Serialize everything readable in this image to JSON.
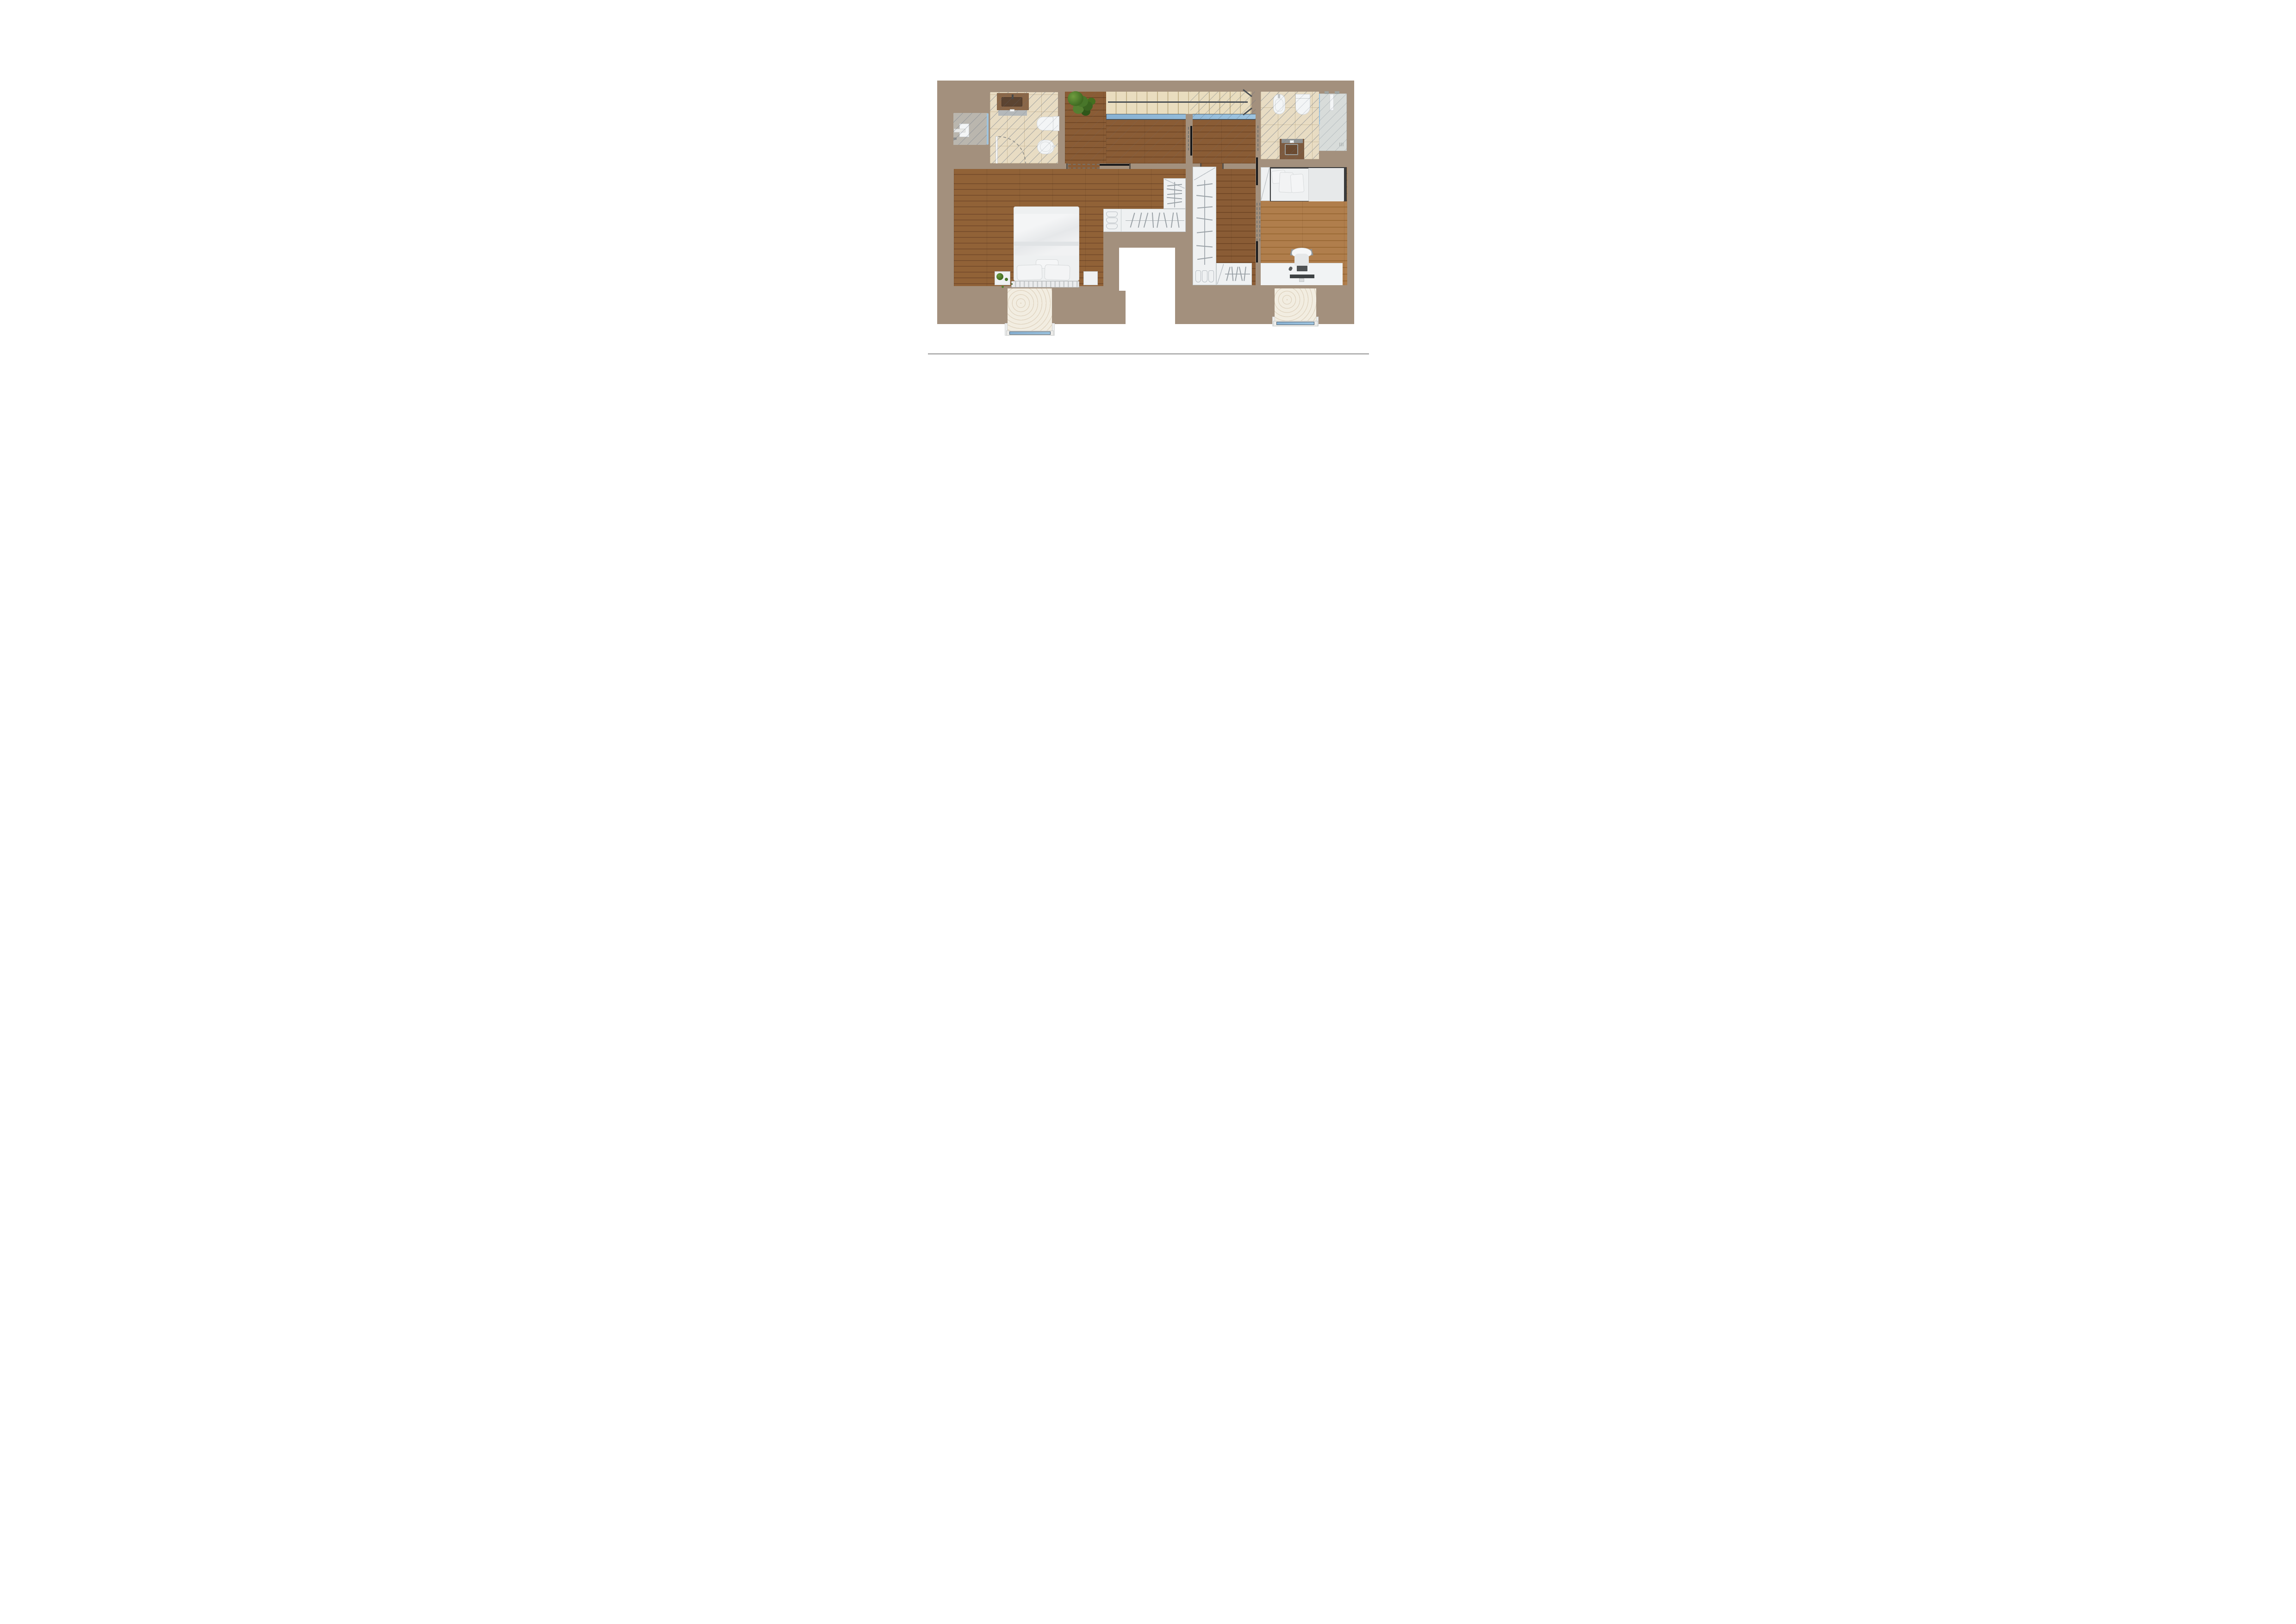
{
  "document": {
    "type": "residential-floor-plan-render",
    "view": "top-down",
    "visible_text": "none",
    "footer_rule_color": "#2b2b2b"
  },
  "palette": {
    "page_background": "#ffffff",
    "wall_fill": "#a3907d",
    "hall_wood": "#8a5c35",
    "master_bedroom_wood": "#916237",
    "second_bedroom_wood": "#b07e4c",
    "bathroom_tile": "#e8dcc3",
    "stair_tread": "#e9ddbf",
    "glass_balustrade_blue": "#92bcd9",
    "travertine_balcony": "#f2ede1",
    "furniture_white": "#eff1f2",
    "vanity_brown": "#8a6748",
    "door_leaf_black": "#17181a",
    "hatch_line_gray": "#6f7c8c"
  },
  "floorplan": {
    "rooms": [
      {
        "id": "bathroom-left",
        "floor": "beige tile with diagonal section hatch",
        "fixtures": [
          "vanity with basin",
          "wall toilet",
          "bidet",
          "hinged door with dashed swing arc",
          "window to service ledge"
        ]
      },
      {
        "id": "service-ledge-left",
        "floor": "gray deck (exterior)",
        "fixtures": [
          "ac-unit",
          "glazing strip"
        ]
      },
      {
        "id": "hallway-landing",
        "floor": "dark wood planks",
        "fixtures": [
          "potted plant",
          "staircase opening with glass balustrade"
        ]
      },
      {
        "id": "staircase",
        "treads": 14,
        "direction_arrow": "pointing right (up)",
        "balustrade": "blue glass strip",
        "section_cut_hatch": "over right half"
      },
      {
        "id": "master-bedroom",
        "floor": "wood planks",
        "fixtures": [
          "double bed with duvet and pillows",
          "tufted headboard",
          "two nightstands",
          "small plant",
          "sliding black door to hallway"
        ]
      },
      {
        "id": "master-walk-in-closet",
        "floor": "wood",
        "fixtures": [
          "L-shaped wardrobe with hanger rails",
          "shoe shelves"
        ]
      },
      {
        "id": "second-walk-in-closet",
        "floor": "wood",
        "fixtures": [
          "tall wardrobe with hanger rail",
          "lower wardrobe with hanger rail",
          "shoe shelves",
          "double dashed door to bedroom"
        ]
      },
      {
        "id": "bathroom-right",
        "floor": "beige tile with diagonal section hatch",
        "fixtures": [
          "bidet",
          "wall toilet",
          "vanity with basin",
          "walk-in shower with glass screen and drain"
        ]
      },
      {
        "id": "second-bedroom",
        "floor": "light wood planks",
        "fixtures": [
          "single bed with pillows",
          "side cabinet",
          "desk with monitor, keyboard and mouse",
          "desk chair"
        ]
      },
      {
        "id": "balcony-left",
        "floor": "travertine",
        "railing": "blue glass with white frame"
      },
      {
        "id": "balcony-right",
        "floor": "travertine",
        "railing": "blue glass with white frame"
      }
    ],
    "doors": [
      {
        "id": "master-bedroom-door",
        "type": "sliding, shown open",
        "leaf_color": "#17181a"
      },
      {
        "id": "suite-vestibule-door",
        "type": "hinged, dashed opening with black leaf"
      },
      {
        "id": "bathroom-right-door",
        "type": "dashed opening"
      },
      {
        "id": "second-bedroom-closet-door",
        "type": "double dashed opening with black leaves"
      },
      {
        "id": "bathroom-left-door",
        "type": "hinged with quarter-circle dashed swing"
      }
    ]
  }
}
